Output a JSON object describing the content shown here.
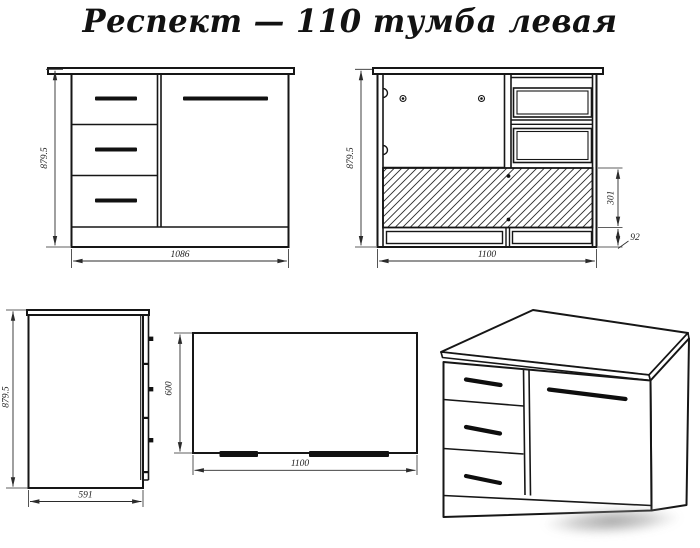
{
  "title": "Респект — 110 тумба левая",
  "views": {
    "front": {
      "height": "879.5",
      "width": "1086"
    },
    "back": {
      "height": "879.5",
      "width": "1100",
      "back_panel_height": "301",
      "plinth_height": "92"
    },
    "side": {
      "height": "879.5",
      "depth": "591"
    },
    "top": {
      "depth": "600",
      "width": "1100"
    }
  },
  "colors": {
    "line": "#161616",
    "dimension_text": "#1d1d1d",
    "background": "#ffffff",
    "watermark": "#9a9a9a"
  }
}
